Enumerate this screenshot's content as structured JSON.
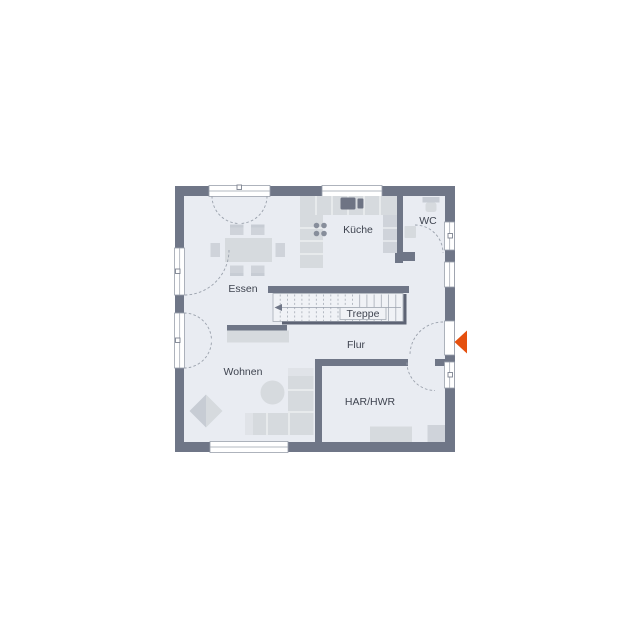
{
  "page": {
    "background": "#ffffff"
  },
  "floorplan": {
    "colors": {
      "wall": "#6f7687",
      "floor": "#e9ecf2",
      "furniture": "#d6dade",
      "line": "#9aa1ac",
      "text": "#3f4450",
      "accent": "#e5500e"
    },
    "rooms": [
      {
        "id": "essen",
        "label": "Essen"
      },
      {
        "id": "kueche",
        "label": "Küche"
      },
      {
        "id": "wc",
        "label": "WC"
      },
      {
        "id": "treppe",
        "label": "Treppe"
      },
      {
        "id": "flur",
        "label": "Flur"
      },
      {
        "id": "wohnen",
        "label": "Wohnen"
      },
      {
        "id": "har-hwr",
        "label": "HAR/HWR"
      }
    ],
    "entrance": {
      "marker": "triangle-arrow",
      "direction": "left",
      "color": "#e5500e"
    },
    "stairs": {
      "direction": "left"
    }
  }
}
